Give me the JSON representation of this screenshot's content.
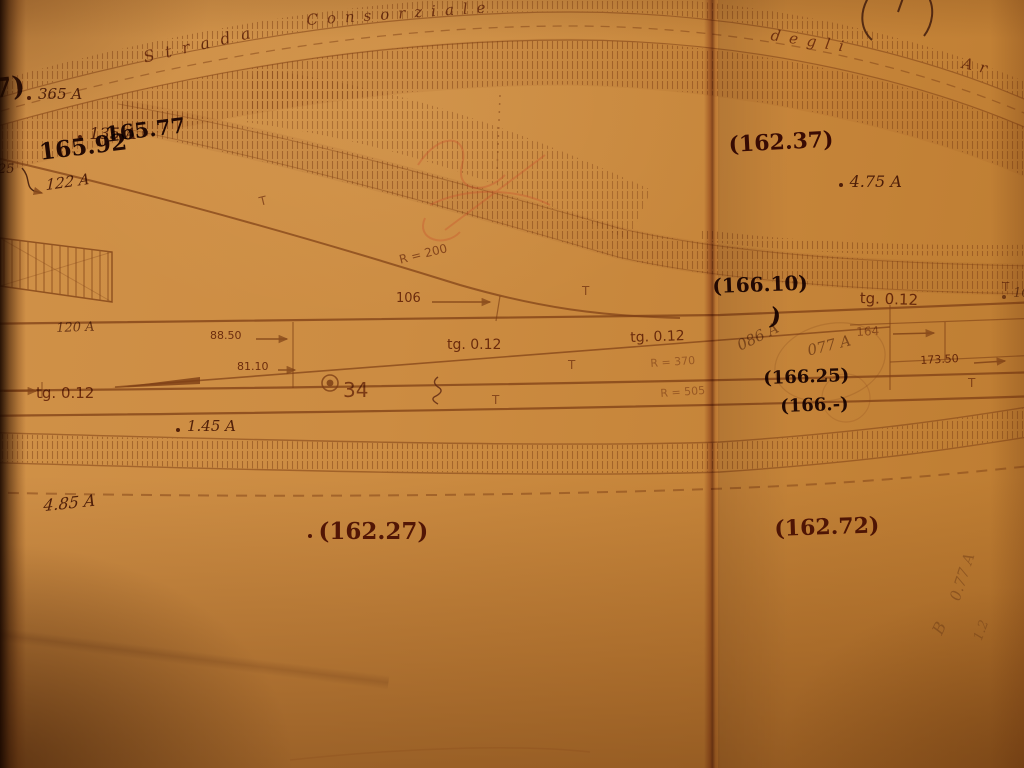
{
  "road_label": {
    "w1": "Strada",
    "w2": "Consorziale",
    "w3": "degli",
    "w4": "Ar"
  },
  "handwritten": {
    "frag_paren7": "7)",
    "pt365": "365 A",
    "pt135": "135 A",
    "el16577": "165.77",
    "el16592": "165.92",
    "pt25": "25",
    "pt122": "122 A",
    "el16237": "(162.37)",
    "pt475": "4.75 A",
    "el16610": "(166.10)",
    "pt102": "102 A",
    "paren": ")",
    "pt086": "086 A",
    "pt077": "077 A",
    "el16625": "(166.25)",
    "el166x": "(166.-)",
    "pt145": "1.45 A",
    "pt485": "4.85 A",
    "el16227": "(162.27)",
    "pt440": "4.40 A",
    "el16272": "(162.72)",
    "rot077": "0.77 A",
    "rotB": "B",
    "rot12": "1.2"
  },
  "printed": {
    "tg": "tg. 0.12",
    "r200": "R = 200",
    "r370": "R = 370",
    "r505": "R = 505",
    "d106": "106",
    "d8850": "88.50",
    "d8110": "81.10",
    "d164": "164",
    "d17350": "173.50",
    "pt120": "120 A",
    "n34": "34",
    "t": "T"
  },
  "colors": {
    "paper": "#c8893f",
    "ink": "#7d3f15",
    "ink_dark": "#2a100a",
    "ink_mid": "#6b2a14",
    "red_scribble": "#c8502a"
  }
}
